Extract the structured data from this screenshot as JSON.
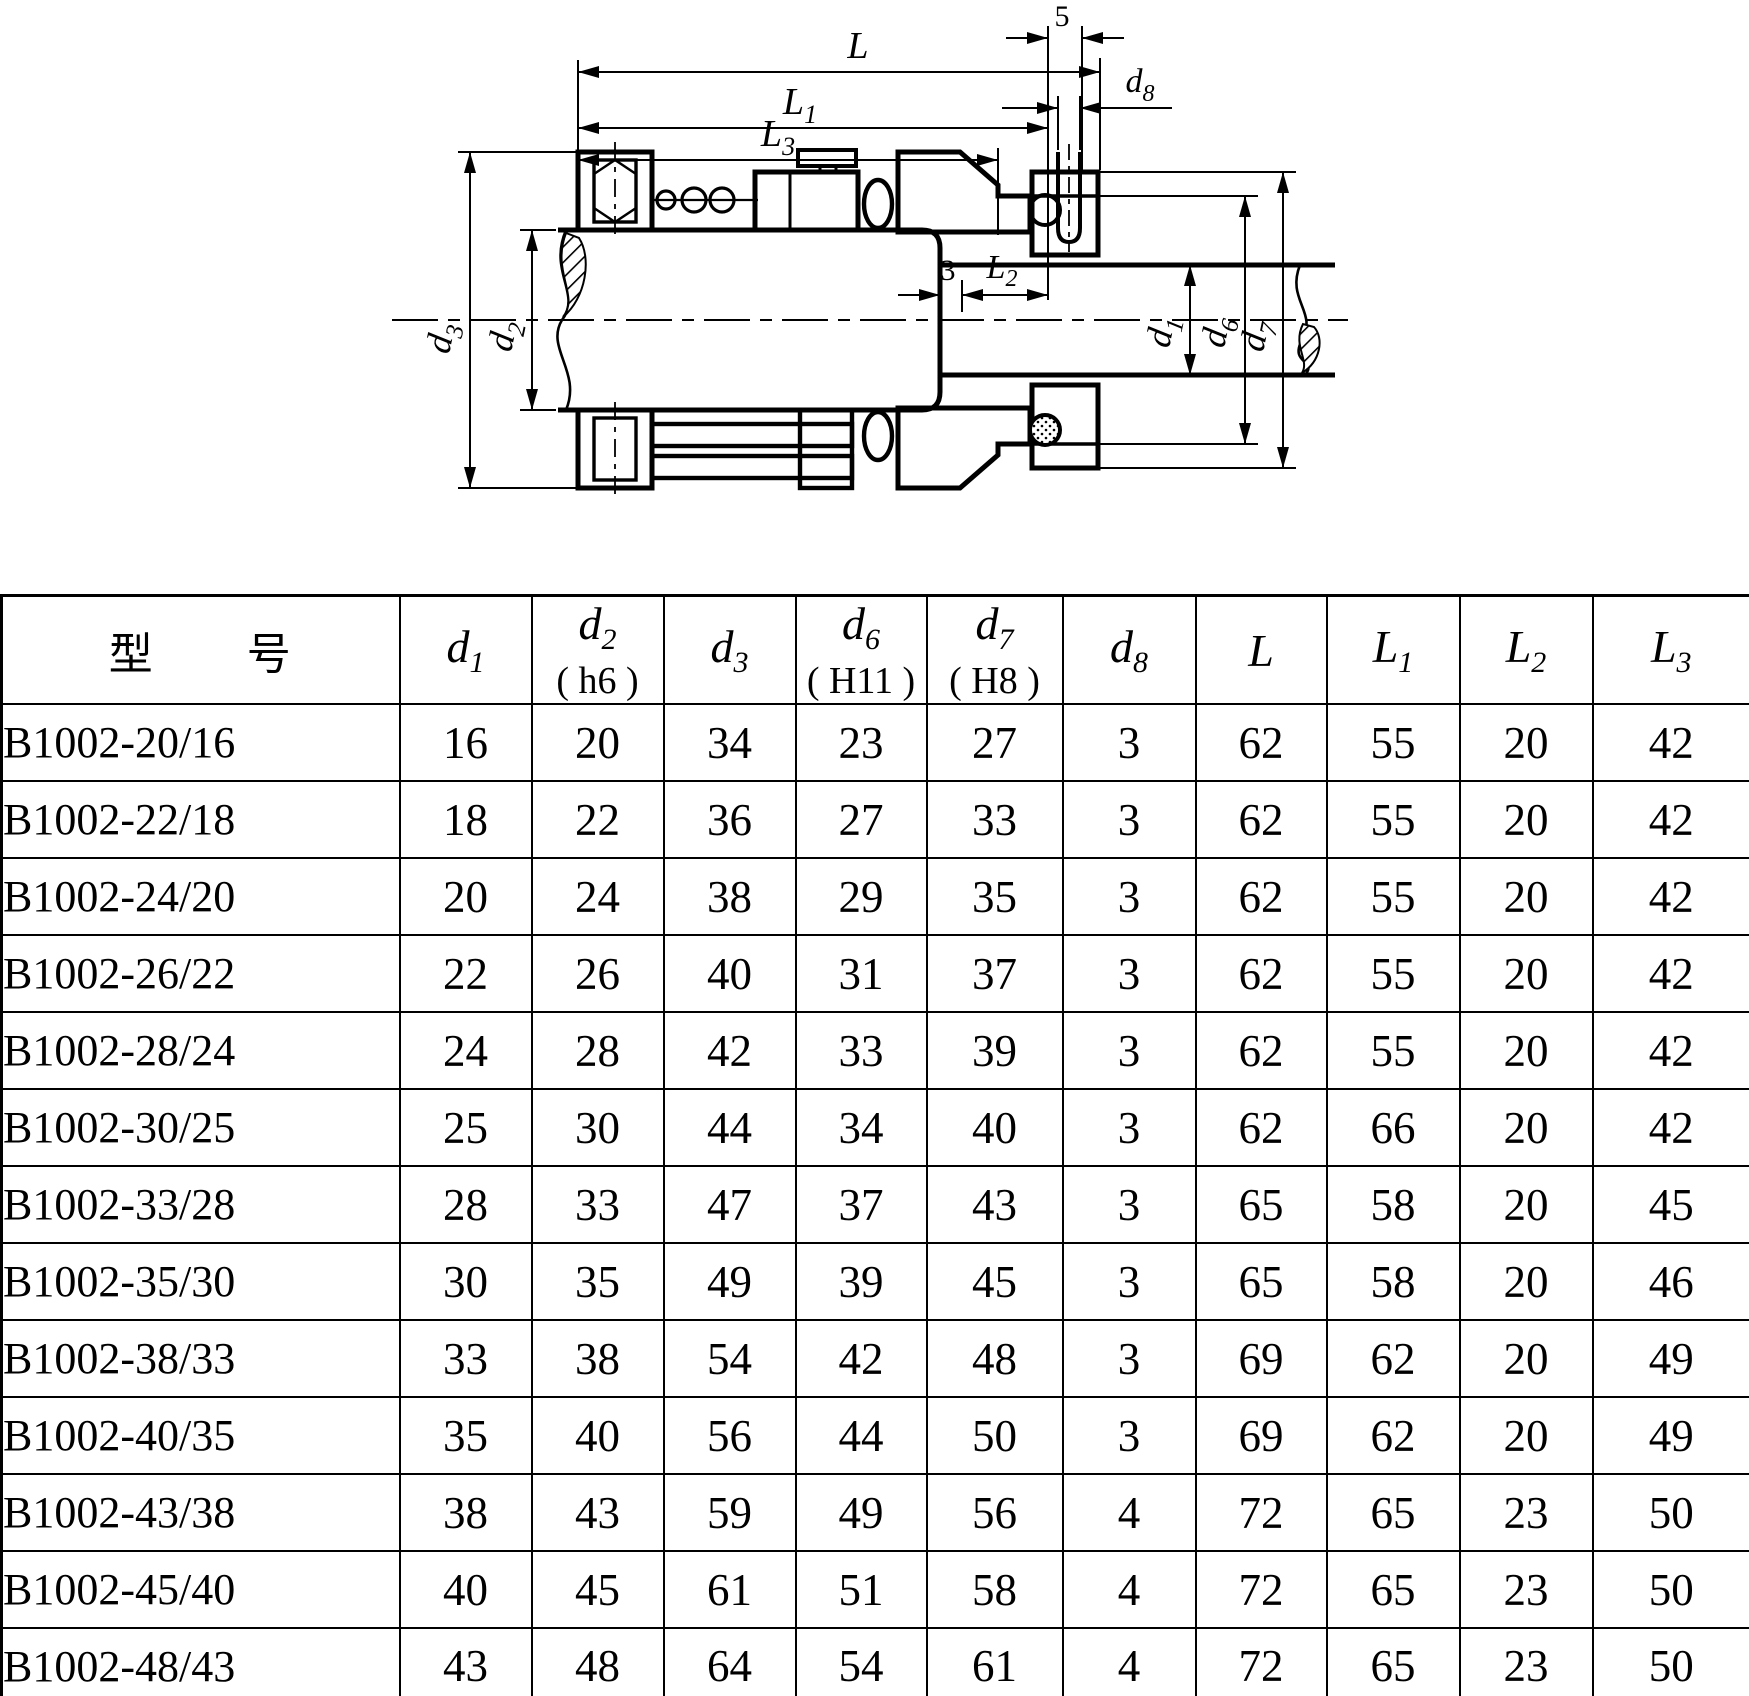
{
  "page": {
    "background": "#ffffff",
    "ink": "#000000"
  },
  "diagram": {
    "description": "mechanical-seal-cross-section",
    "labels": {
      "five": "5",
      "three": "3",
      "L": {
        "base": "L",
        "sub": ""
      },
      "L1": {
        "base": "L",
        "sub": "1"
      },
      "L2": {
        "base": "L",
        "sub": "2"
      },
      "L3": {
        "base": "L",
        "sub": "3"
      },
      "d1": {
        "base": "d",
        "sub": "1"
      },
      "d2": {
        "base": "d",
        "sub": "2"
      },
      "d3": {
        "base": "d",
        "sub": "3"
      },
      "d6": {
        "base": "d",
        "sub": "6"
      },
      "d7": {
        "base": "d",
        "sub": "7"
      },
      "d8": {
        "base": "d",
        "sub": "8"
      }
    }
  },
  "table": {
    "headers": [
      {
        "label": "型　　号",
        "sub": "",
        "note": "",
        "kind": "plain"
      },
      {
        "label": "d",
        "sub": "1",
        "note": "",
        "kind": "dim"
      },
      {
        "label": "d",
        "sub": "2",
        "note": "( h6 )",
        "kind": "dim"
      },
      {
        "label": "d",
        "sub": "3",
        "note": "",
        "kind": "dim"
      },
      {
        "label": "d",
        "sub": "6",
        "note": "( H11 )",
        "kind": "dim"
      },
      {
        "label": "d",
        "sub": "7",
        "note": "( H8 )",
        "kind": "dim"
      },
      {
        "label": "d",
        "sub": "8",
        "note": "",
        "kind": "dim"
      },
      {
        "label": "L",
        "sub": "",
        "note": "",
        "kind": "dim"
      },
      {
        "label": "L",
        "sub": "1",
        "note": "",
        "kind": "dim"
      },
      {
        "label": "L",
        "sub": "2",
        "note": "",
        "kind": "dim"
      },
      {
        "label": "L",
        "sub": "3",
        "note": "",
        "kind": "dim"
      }
    ],
    "rows": [
      [
        "B1002-20/16",
        "16",
        "20",
        "34",
        "23",
        "27",
        "3",
        "62",
        "55",
        "20",
        "42"
      ],
      [
        "B1002-22/18",
        "18",
        "22",
        "36",
        "27",
        "33",
        "3",
        "62",
        "55",
        "20",
        "42"
      ],
      [
        "B1002-24/20",
        "20",
        "24",
        "38",
        "29",
        "35",
        "3",
        "62",
        "55",
        "20",
        "42"
      ],
      [
        "B1002-26/22",
        "22",
        "26",
        "40",
        "31",
        "37",
        "3",
        "62",
        "55",
        "20",
        "42"
      ],
      [
        "B1002-28/24",
        "24",
        "28",
        "42",
        "33",
        "39",
        "3",
        "62",
        "55",
        "20",
        "42"
      ],
      [
        "B1002-30/25",
        "25",
        "30",
        "44",
        "34",
        "40",
        "3",
        "62",
        "66",
        "20",
        "42"
      ],
      [
        "B1002-33/28",
        "28",
        "33",
        "47",
        "37",
        "43",
        "3",
        "65",
        "58",
        "20",
        "45"
      ],
      [
        "B1002-35/30",
        "30",
        "35",
        "49",
        "39",
        "45",
        "3",
        "65",
        "58",
        "20",
        "46"
      ],
      [
        "B1002-38/33",
        "33",
        "38",
        "54",
        "42",
        "48",
        "3",
        "69",
        "62",
        "20",
        "49"
      ],
      [
        "B1002-40/35",
        "35",
        "40",
        "56",
        "44",
        "50",
        "3",
        "69",
        "62",
        "20",
        "49"
      ],
      [
        "B1002-43/38",
        "38",
        "43",
        "59",
        "49",
        "56",
        "4",
        "72",
        "65",
        "23",
        "50"
      ],
      [
        "B1002-45/40",
        "40",
        "45",
        "61",
        "51",
        "58",
        "4",
        "72",
        "65",
        "23",
        "50"
      ],
      [
        "B1002-48/43",
        "43",
        "48",
        "64",
        "54",
        "61",
        "4",
        "72",
        "65",
        "23",
        "50"
      ]
    ]
  }
}
